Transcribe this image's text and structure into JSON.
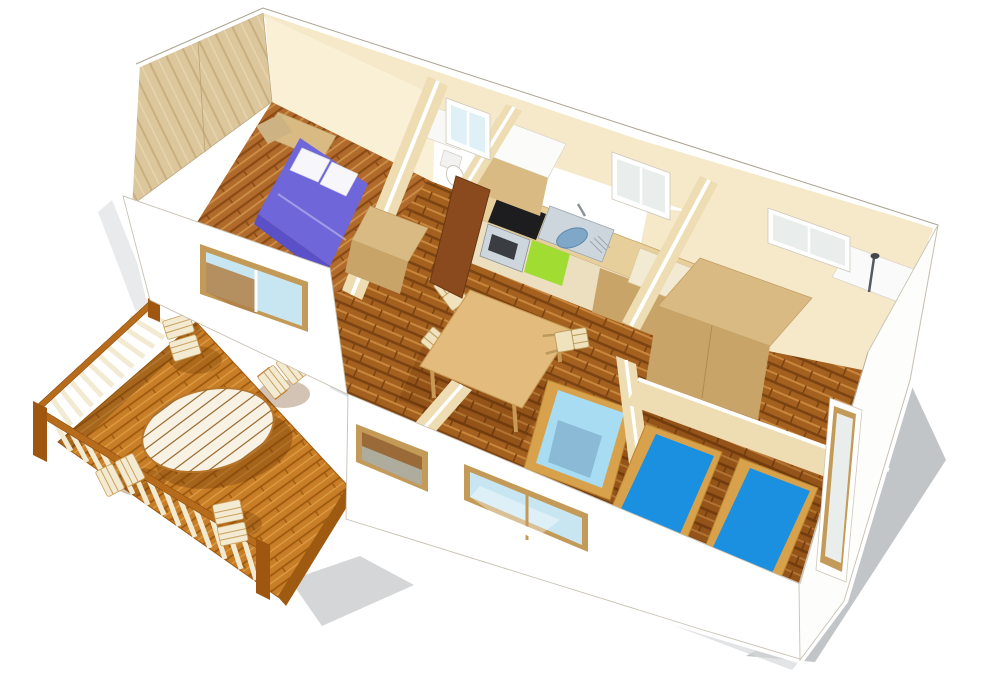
{
  "scene": {
    "title": "3D isometric floor plan — mobile home with wooden terrace",
    "style": "cutaway architectural rendering viewed from above, no roof",
    "rooms": [
      {
        "name": "master-bedroom",
        "label": "Master bedroom",
        "furniture": [
          "double bed with purple duvet",
          "two white pillows",
          "headboard shelf",
          "wardrobe"
        ]
      },
      {
        "name": "wc",
        "label": "WC",
        "furniture": [
          "toilet",
          "washbasin unit",
          "window"
        ]
      },
      {
        "name": "kitchen",
        "label": "Kitchen",
        "furniture": [
          "worktop",
          "steel sink with faucet",
          "black cooktop",
          "oven",
          "green dishwasher front",
          "fridge cabinet",
          "interior door",
          "window"
        ]
      },
      {
        "name": "living-dining",
        "label": "Living / dining area",
        "furniture": [
          "wooden dining table",
          "three ladder-back chairs",
          "single day bed with light blue mattress"
        ]
      },
      {
        "name": "bathroom",
        "label": "Bathroom",
        "furniture": [
          "shower fixture",
          "white shower tray",
          "window"
        ]
      },
      {
        "name": "kids-bedroom",
        "label": "Second bedroom",
        "furniture": [
          "two single beds with bright blue mattresses",
          "tall side window"
        ]
      },
      {
        "name": "hallway",
        "label": "Hallway",
        "furniture": [
          "large wardrobe unit"
        ]
      }
    ],
    "terrace": {
      "name": "terrace",
      "label": "Wooden deck terrace",
      "furniture": [
        "oval slatted table",
        "four slatted garden chairs",
        "guard railing on two sides"
      ]
    },
    "window_count": 7
  },
  "palette": {
    "wall_white": "#ffffff",
    "wall_off": "#fdfdfb",
    "outline": "#b7ae9e",
    "cream": "#f6e9ca",
    "cream_dark": "#eedcb2",
    "cream_lit": "#f9f0d6",
    "panel_wood": "#dcc69b",
    "panel_grain": "#c9ae7f",
    "panel_light": "#e6d4ae",
    "floor_base": "#a4601f",
    "floor_dark": "#7c4312",
    "floor_light": "#c8873c",
    "bed1_base": "#b06a2c",
    "bed1_dark": "#8a4a14",
    "bed1_light": "#cd8f46",
    "deck_base": "#c87e26",
    "deck_dark": "#9e5a10",
    "deck_light": "#dc9a44",
    "rail_frame": "#b76c1c",
    "rail_post": "#9e5610",
    "baluster": "#f3ead2",
    "table_white": "#f7f2e3",
    "table_rim": "#b8762a",
    "purple": "#6f66d9",
    "purple_dark": "#5a50c8",
    "pillow": "#f7f7fb",
    "lightblue": "#a8dcf2",
    "blue": "#1b8fe0",
    "blue_dark": "#0e7ace",
    "bedframe": "#d8a24c",
    "glass_blue": "#c8e6f2",
    "glass_gray": "#e9eeec",
    "glass_interior": "#9a6a38",
    "frame_wood": "#c49a58",
    "counter": "#e7cf9c",
    "counter_front": "#ecdfc0",
    "cabinet": "#d9ba82",
    "cabinet_dark": "#c9a468",
    "door": "#8a4a1e",
    "steel": "#cdd6dc",
    "steel_dark": "#7fa8c8",
    "black": "#1d1d1f",
    "green": "#a0dc32",
    "shadow": "#b7bbbd",
    "shadow_soft": "#d6d9da",
    "white_fix": "#fafafa"
  }
}
